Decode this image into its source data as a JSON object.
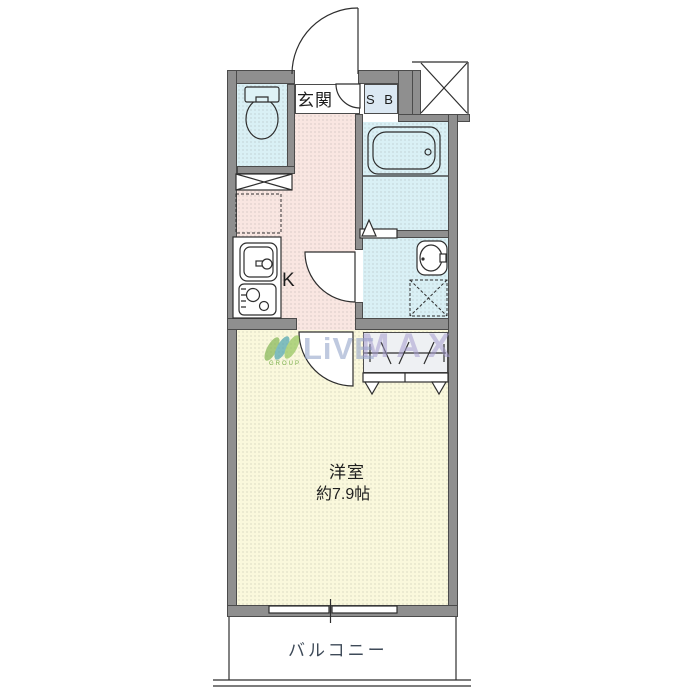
{
  "labels": {
    "entrance": "玄関",
    "shoe_box": "S B",
    "kitchen": "K",
    "room_name": "洋室",
    "room_size": "約7.9帖",
    "balcony": "バルコニー"
  },
  "watermark": {
    "live": "LiVE",
    "max": "MAX",
    "group": "GROUP"
  },
  "colors": {
    "wall": "#8f8f8f",
    "wall_edge": "#4b4b4b",
    "wet_area": "#d9f0f5",
    "kitchen": "#f9e6e1",
    "main_room": "#faf8dc",
    "shoe_box": "#dbe8f3",
    "closet": "#eef0f3",
    "line": "#2e2e2e",
    "watermark_blue": "#97a8cb",
    "watermark_purple": "#a59dce",
    "logo_green": "#7ab04a",
    "logo_teal": "#3f9fae"
  }
}
